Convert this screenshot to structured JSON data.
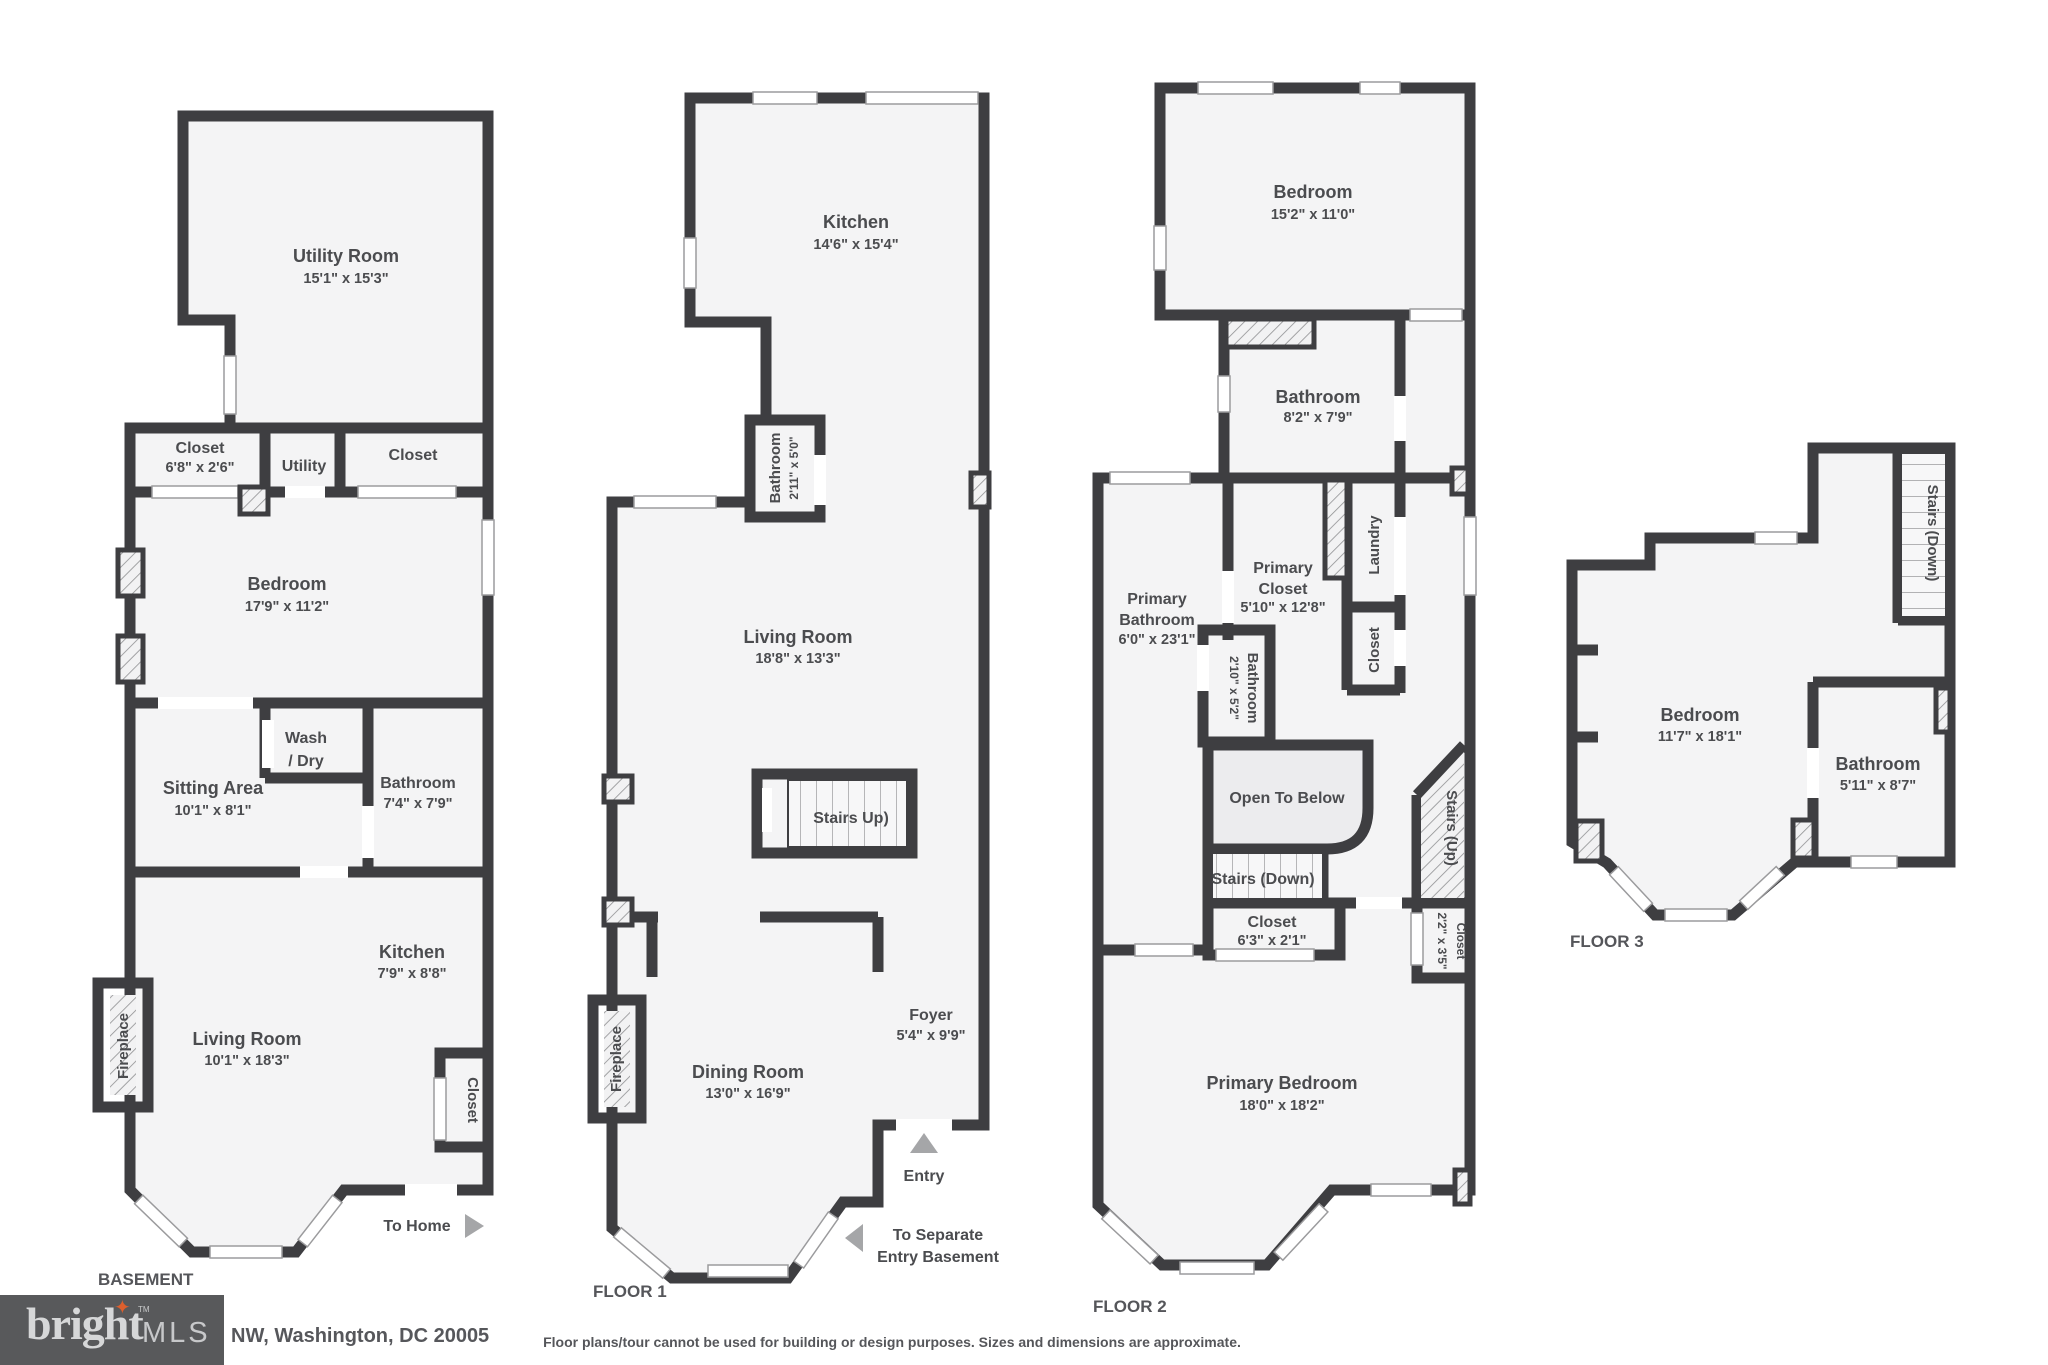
{
  "page": {
    "address": "NW, Washington, DC 20005",
    "disclaimer": "Floor plans/tour cannot be used for building or design purposes. Sizes and dimensions are approximate."
  },
  "logo": {
    "brand": "bright",
    "tm": "TM",
    "suffix": "MLS"
  },
  "colors": {
    "wall": "#3e3e41",
    "room_fill": "#f4f4f5",
    "open_below_fill": "#ececee",
    "logo_background": "#58595b",
    "logo_star": "#dd5f2d",
    "arrow": "#a5a6a8"
  },
  "floors": {
    "basement": {
      "label": "BASEMENT",
      "utility_room": {
        "name": "Utility Room",
        "dims": "15'1\" x 15'3\""
      },
      "closet_left": {
        "name": "Closet",
        "dims": "6'8\" x 2'6\""
      },
      "utility": {
        "name": "Utility"
      },
      "closet_right": {
        "name": "Closet"
      },
      "bedroom": {
        "name": "Bedroom",
        "dims": "17'9\" x 11'2\""
      },
      "wash_dry": {
        "line1": "Wash",
        "line2": "/ Dry"
      },
      "sitting_area": {
        "name": "Sitting Area",
        "dims": "10'1\" x 8'1\""
      },
      "bathroom": {
        "name": "Bathroom",
        "dims": "7'4\" x 7'9\""
      },
      "kitchen": {
        "name": "Kitchen",
        "dims": "7'9\" x 8'8\""
      },
      "living_room": {
        "name": "Living Room",
        "dims": "10'1\" x 18'3\""
      },
      "fireplace": {
        "name": "Fireplace"
      },
      "closet_lower": {
        "name": "Closet"
      },
      "to_home": {
        "name": "To Home"
      }
    },
    "floor1": {
      "label": "FLOOR 1",
      "kitchen": {
        "name": "Kitchen",
        "dims": "14'6\" x 15'4\""
      },
      "bathroom": {
        "name": "Bathroom",
        "dims": "2'11\" x 5'0\""
      },
      "living_room": {
        "name": "Living Room",
        "dims": "18'8\" x 13'3\""
      },
      "stairs_up": {
        "name": "Stairs Up)"
      },
      "foyer": {
        "name": "Foyer",
        "dims": "5'4\" x 9'9\""
      },
      "dining_room": {
        "name": "Dining Room",
        "dims": "13'0\" x 16'9\""
      },
      "fireplace": {
        "name": "Fireplace"
      },
      "entry": {
        "name": "Entry"
      },
      "to_separate": {
        "line1": "To Separate",
        "line2": "Entry Basement"
      }
    },
    "floor2": {
      "label": "FLOOR 2",
      "bedroom": {
        "name": "Bedroom",
        "dims": "15'2\" x 11'0\""
      },
      "bathroom": {
        "name": "Bathroom",
        "dims": "8'2\" x 7'9\""
      },
      "primary_bathroom": {
        "line1": "Primary",
        "line2": "Bathroom",
        "dims": "6'0\" x 23'1\""
      },
      "primary_closet": {
        "line1": "Primary",
        "line2": "Closet",
        "dims": "5'10\" x 12'8\""
      },
      "bathroom_small": {
        "name": "Bathroom",
        "dims": "2'10\" x 5'2\""
      },
      "laundry": {
        "name": "Laundry"
      },
      "closet_mid": {
        "name": "Closet"
      },
      "open_to_below": {
        "name": "Open To Below"
      },
      "stairs_up": {
        "name": "Stairs (Up)"
      },
      "stairs_down": {
        "name": "Stairs (Down)"
      },
      "closet_lower": {
        "name": "Closet",
        "dims": "6'3\" x 2'1\""
      },
      "closet_small": {
        "name": "Closet",
        "dims": "2'2\" x 3'5\""
      },
      "primary_bedroom": {
        "name": "Primary Bedroom",
        "dims": "18'0\" x 18'2\""
      }
    },
    "floor3": {
      "label": "FLOOR 3",
      "stairs_down": {
        "name": "Stairs (Down)"
      },
      "bedroom": {
        "name": "Bedroom",
        "dims": "11'7\" x 18'1\""
      },
      "bathroom": {
        "name": "Bathroom",
        "dims": "5'11\" x 8'7\""
      }
    }
  }
}
